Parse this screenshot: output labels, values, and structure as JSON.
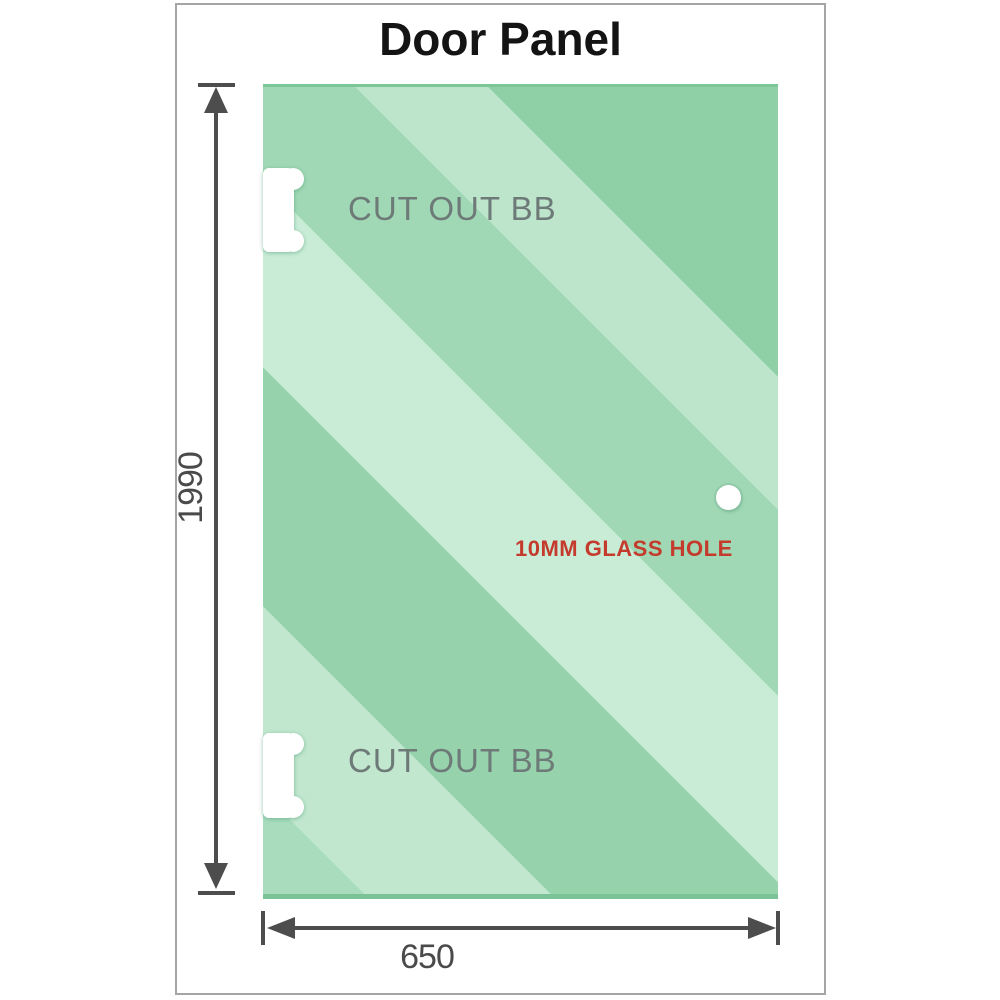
{
  "title": "Door Panel",
  "panel": {
    "cutouts": [
      {
        "label": "CUT OUT BB"
      },
      {
        "label": "CUT OUT BB"
      }
    ],
    "glass_hole": {
      "label": "10MM GLASS HOLE"
    }
  },
  "dimensions": {
    "height": {
      "label": "1990"
    },
    "width": {
      "label": "650"
    }
  },
  "colors": {
    "glass_base": "#96d3ac",
    "glass_highlight": "#c9ecd7",
    "dimension_line": "#4d4d4d",
    "cutout_text": "#6e7a78",
    "hole_text": "#c43a2c",
    "title_text": "#141414",
    "frame_border": "#a5a5a5"
  }
}
